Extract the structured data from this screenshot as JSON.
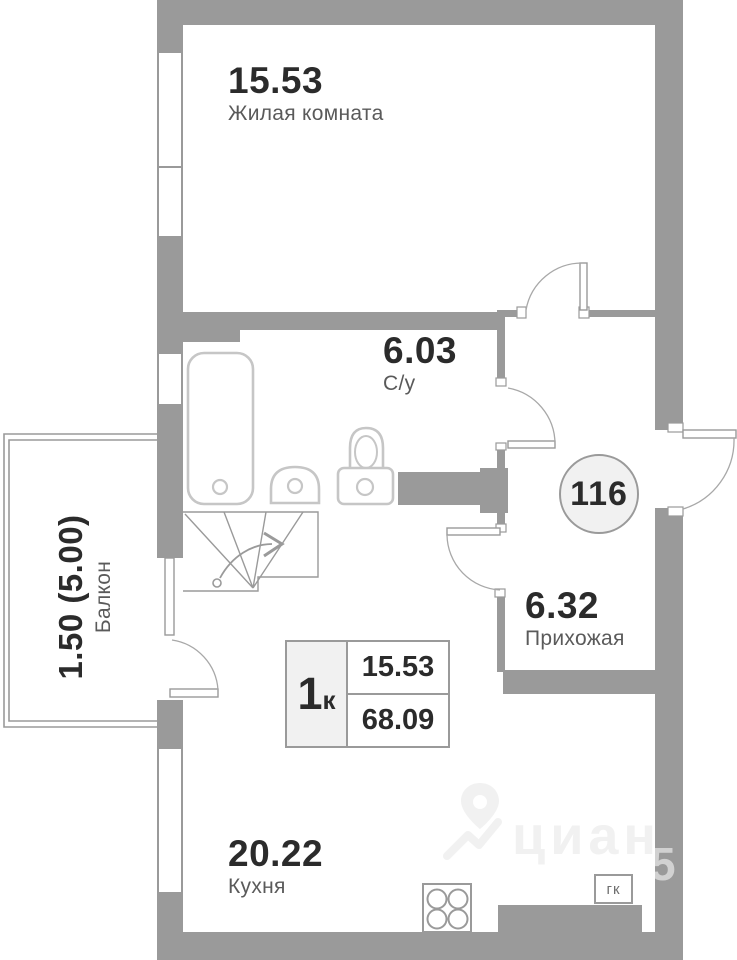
{
  "plan": {
    "unit_number": "116",
    "info_box": {
      "rooms_digit": "1",
      "rooms_suffix": "к",
      "living_area": "15.53",
      "total_area": "68.09"
    },
    "rooms": [
      {
        "id": "living-room",
        "area": "15.53",
        "label": "Жилая комната"
      },
      {
        "id": "bathroom",
        "area": "6.03",
        "label": "С/у"
      },
      {
        "id": "hallway",
        "area": "6.32",
        "label": "Прихожая"
      },
      {
        "id": "kitchen",
        "area": "20.22",
        "label": "Кухня"
      },
      {
        "id": "balcony",
        "area": "1.50 (5.00)",
        "label": "Балкон"
      }
    ],
    "closet_label": "гк",
    "watermark": {
      "brand": "циан",
      "digit": "5"
    },
    "colors": {
      "wall": "#9a9a9a",
      "fixture": "#c6c6c6",
      "text_primary": "#2b2b2b",
      "text_secondary": "#5a5a5a",
      "unit_badge_fill": "#f1f1f1"
    }
  }
}
